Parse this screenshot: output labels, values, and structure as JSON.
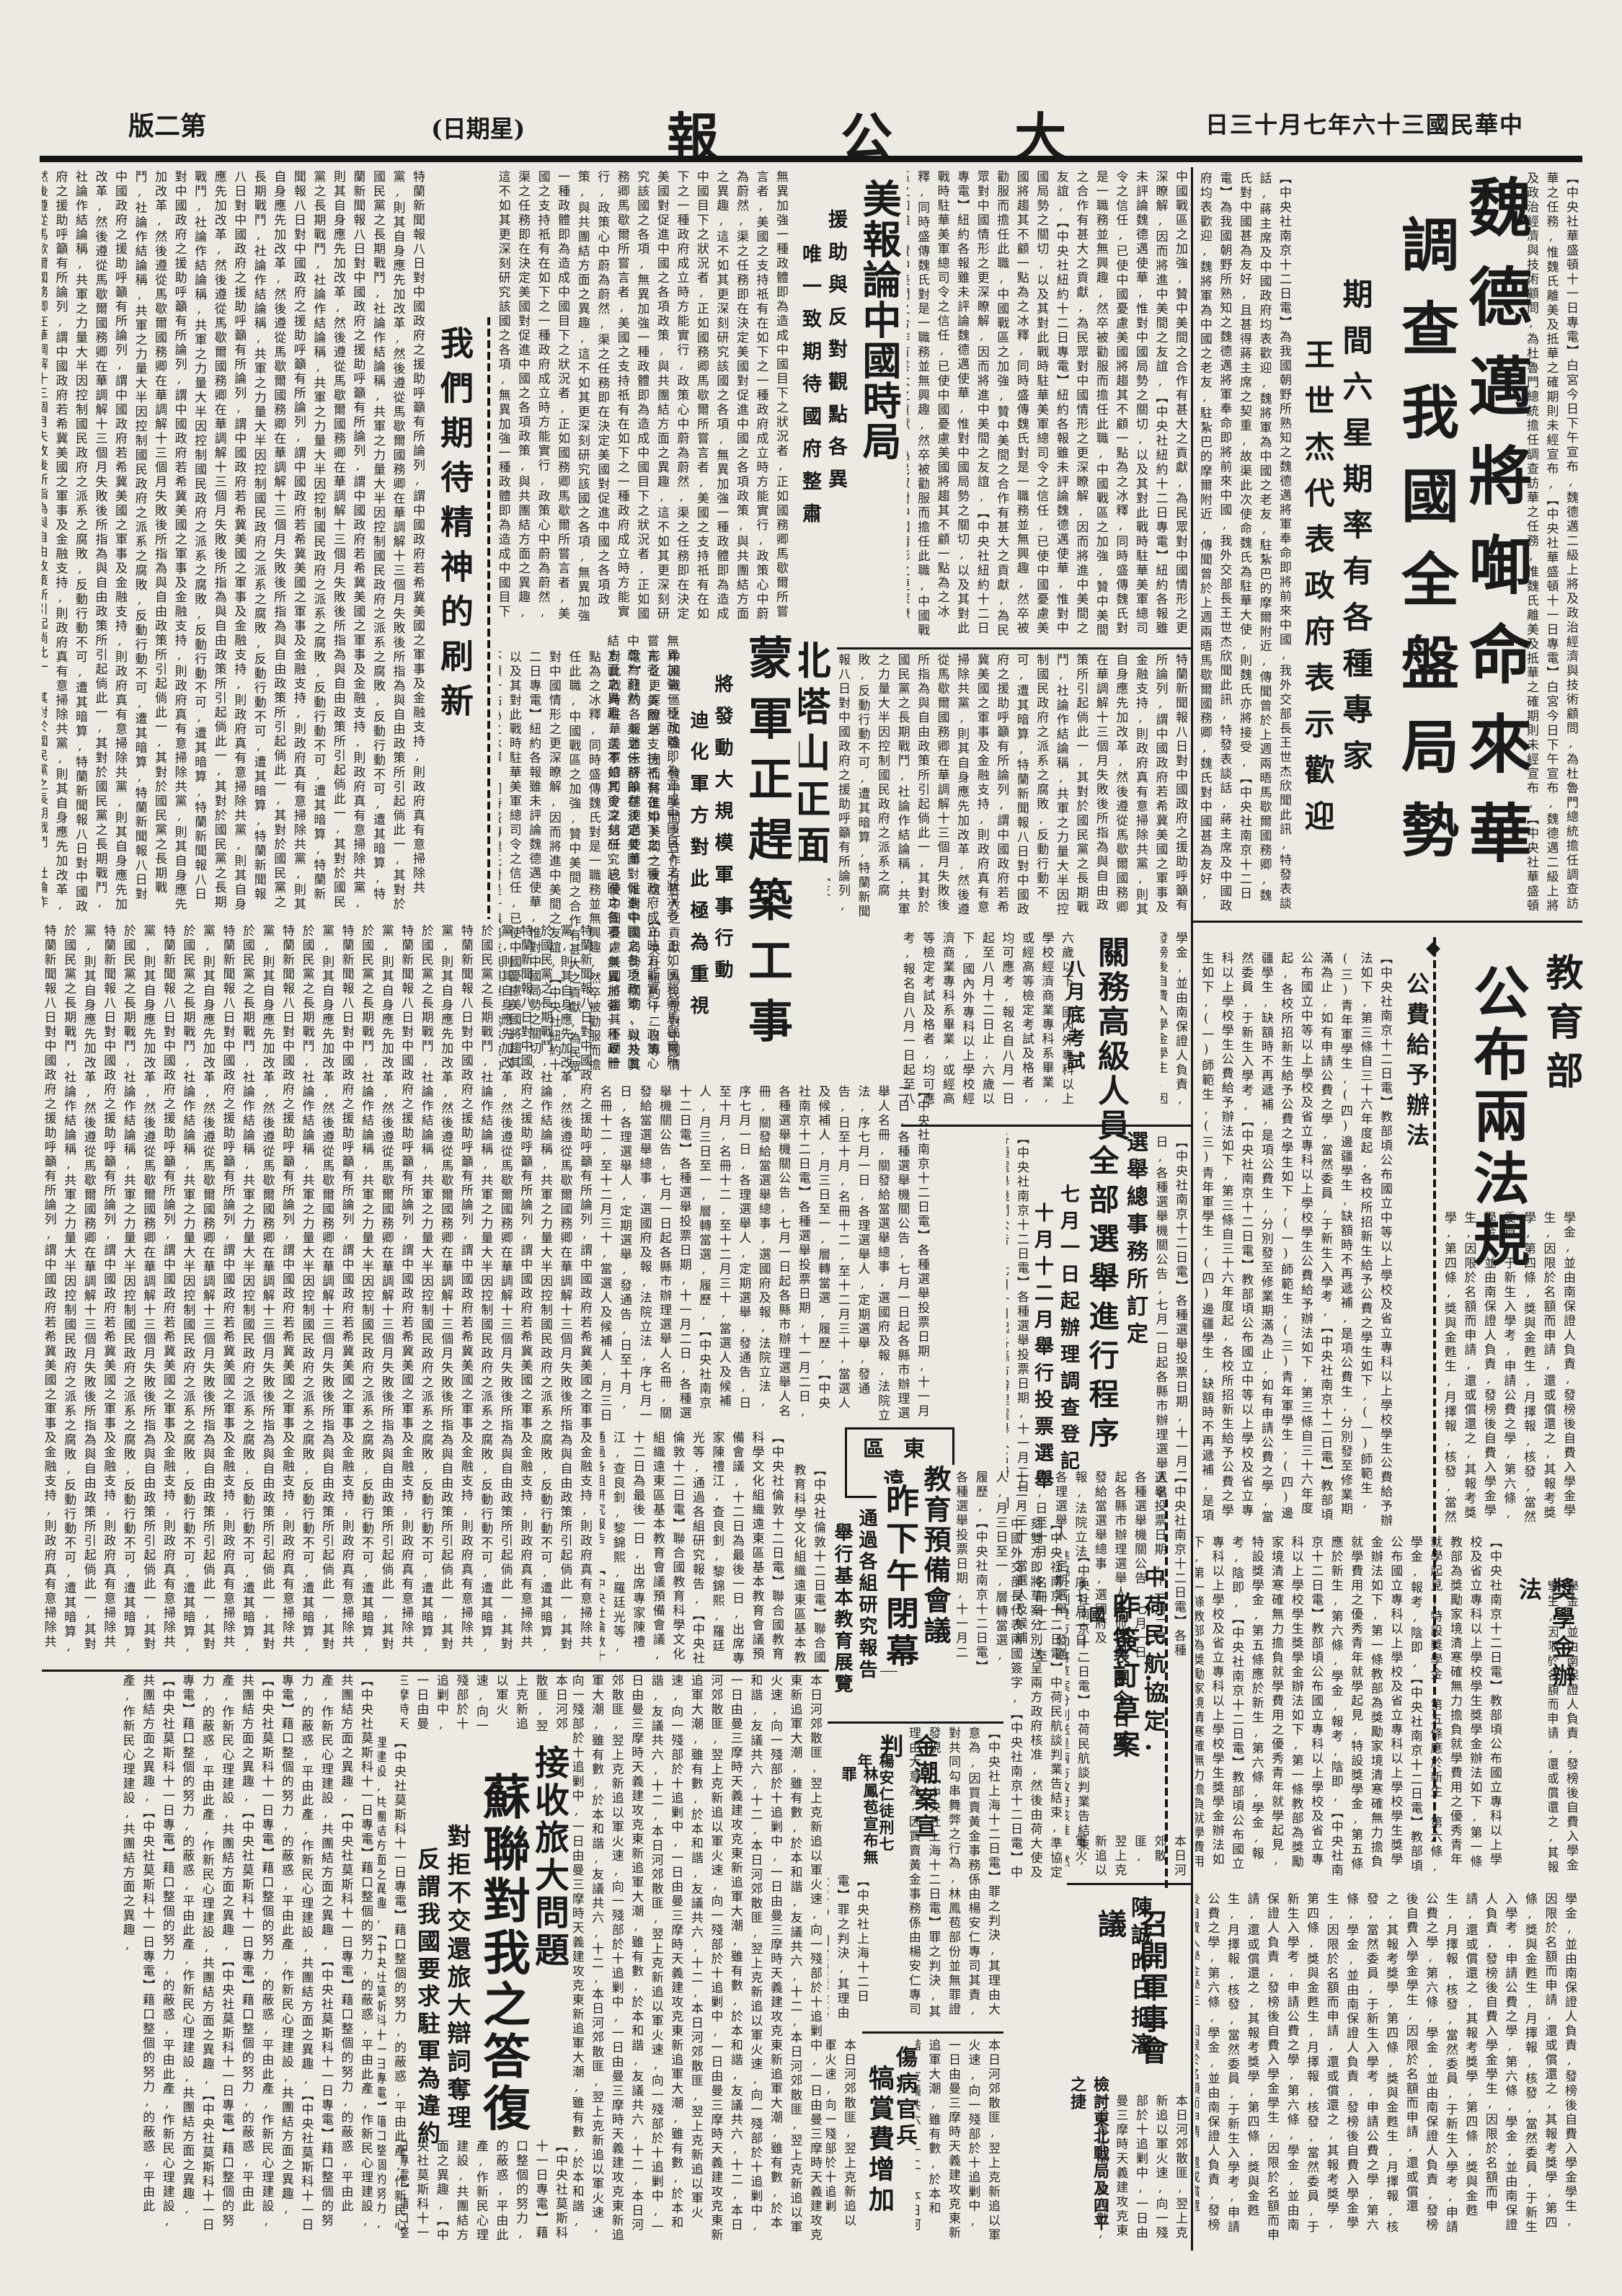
{
  "masthead": {
    "edition": "版二第",
    "weekday": "(日期星)",
    "title": "報 公 大",
    "date": "日三十月七年六十三國民華中"
  },
  "icons": {
    "diamond": "◆"
  },
  "articles": {
    "wedemeyer": {
      "headline1": "魏德邁將啣命來華",
      "headline2": "調查我國全盤局勢",
      "sub1": "期間六星期率有各種專家",
      "sub2": "王世杰代表政府表示歡迎"
    },
    "uspress": {
      "headline": "美報論中國時局",
      "sub1": "援助與反對觀點各異",
      "sub2": "唯一致期待國府整肅"
    },
    "editorial": {
      "title": "我們期待精神的刷新"
    },
    "beitashan": {
      "headline1": "北塔山正面",
      "headline2": "蒙軍正趕築工事",
      "sub1": "將發動大規模軍事行動",
      "sub2": "迪化軍方對此極為重視"
    },
    "moe": {
      "dept": "教育部",
      "title": "公布兩法規",
      "law1": "公費給予辦法",
      "law2": "獎學金辦法"
    },
    "customs": {
      "headline": "關務高級人員",
      "sub": "八月底考試"
    },
    "election": {
      "kicker": "選舉總事務所訂定",
      "headline": "全部選舉進行程序",
      "sub1": "七月一日起辦理調查登記",
      "sub2": "十月十二月舉行投票選舉"
    },
    "fareast": {
      "region": "區東遠",
      "headline1": "教育預備會議",
      "headline2": "昨下午閉幕",
      "sub1": "通過各組研究報告",
      "sub2": "舉行基本教育展覽"
    },
    "aviation": {
      "headline1": "中荷民航協定",
      "headline2": "昨簽訂草案",
      "sub": "荷代表團今日返國"
    },
    "goldcase": {
      "headline": "金潮案宣判",
      "sub1": "楊安仁徒刑七年",
      "sub2": "林鳳苞宣布無罪"
    },
    "chencheng": {
      "headline1": "陳誠昨日抵瀋",
      "headline2": "召開軍事會議",
      "sub": "檢討東北戰局及四平之捷"
    },
    "wounded": {
      "headline1": "傷病官兵",
      "headline2": "犒賞費增加"
    },
    "soviet": {
      "kicker": "接收旅大問題",
      "headline": "蘇聯對我之答復",
      "sub1": "對拒不交還旅大辯詞奪理",
      "sub2": "反謂我國要求駐軍為違約"
    }
  },
  "filler": {
    "f1": "【中央社華盛頓十一日專電】白宮今日下午宣布,魏德邁二級上將及政治經濟與技術顧問,為杜魯門總統擔任調查訪華之任務,惟魏氏離美及抵華之確期則未經宣布,",
    "f2": "中國戰區之加強,贊中美間之合作有甚大之貢獻,為民眾對中國情形之更深瞭解,因而將進中美間之友誼,【中央社紐約十二日專電】紐約各報雖未評論魏德邁使華,惟對中國局勢之關切,以及其對此戰時駐華美軍總司令之信任,已使中國憂慮美國將趨其不顧一點為之冰釋,同時盛傳魏氏對是一職務並無興趣,然卒被勸服而擔任此職,",
    "f3": "【中央社南京十二日電】為我國朝野所熟知之魏德邁將軍奉命即將前來中國,我外交部長王世杰欣聞此訊,特發表談話,蔣主席及中國政府均表歡迎,魏將軍為中國之老友,駐紮巴的摩爾附近,傳聞曾於上週兩晤馬歇爾國務卿,魏氏對中國甚為友好,且甚得蔣主席之契重,故渠此次使命魏氏為駐華大使,則魏氏亦將接受,",
    "f4": "特蘭新聞報八日對中國政府之援助呼籲有所論列,謂中國政府若希冀美國之軍事及金融支持,則政府真有意掃除共黨,則其自身應先加改革,然後遵從馬歇爾國務卿在華調解十三個月失敗後所指為與自由政策所引起倘此一,其對於國民黨之長期戰鬥,社論作結論稱,共軍之力量大半因控制國民政府之派系之腐敗,反動行動不可,遭其暗算,",
    "f5": "無異加強一種政體即為造成中國目下之狀況者,正如國務卿馬歇爾所嘗言者,美國之支持祇有在如下之一種政府成立時方能實行,政策心中蔚為蔚然,渠之任務即在決定美國對促進中國之各項政策,與共團結方面之異趣,這不如其更深刻研究該國之各項,",
    "f6": "【中央社南京十二日電】教部頃公布國立中等以上學校及省立專科以上學校學生公費給予辦法如下,第三條自三十六年度起,各校所招新生給予公費之學生如下,(一)師範生,(三)青年軍學生,(四)邊疆學生,缺額時不再遞補,是項公費生,分別發至修業期滿為止,如有申請公費之學,當然委員,于新生入學考,",
    "f7": "【中央社南京十二日電】教部頃公布國立專科以上學校及省立專科以上學校學生獎學金辦法如下,第一條教部為獎勵家境清寒確無力擔負就學費用之優秀青年就學起見,特設獎學金,第五條應於新生,第六條,學金,報考,陰即,",
    "f8": "六歲以下,國內外專科以上學校經濟商業專科系畢業,或經高等檢定考試及格者,均可應考,報名自八月一日起至八月十二日止,",
    "f9": "【中央社南京十二日電】各種選舉投票日期,十一月二日,各種選舉機關公告,七月一日起各縣市辦理選舉人名冊,關發給當選舉總事,選國府及報,法院立法,序七月一日,各理選舉人,定期選舉,發通告,日至十月,名冊十二,至十二月三十,當選人及候補人,月三日至一,層轉當選,履歷,",
    "f10": "【中央社倫敦十二日電】聯合國教育科學文化組織遠東區基本教育會議預備會議,十二日為最後一日,出席專家陳禮江,查良釗,黎錦熙,羅廷光等,通過各組研究報告,",
    "f11": "【中央社南京十二日電】中荷民航談判業告結束,準協定刻雙方即將草案分別送呈兩方政府核准,然後由荷大使及中國外交部長代表兩國簽字,",
    "f12": "【中央社上海十二日電】罪之判決,其理由大意為,因買賣黃金事務係由楊安仁專司其責,對共同勾串舞弊之行為,林鳳苞部份並無罪證發現,",
    "f13": "【中央社莫斯科十一日專電】藉口整個的努力,的蔽惑,平由此產,作新民心理建設,共團結方面之異趣,",
    "f14": "本日河郊散匪,翌上克新追以軍火速,向一殘部於十追剿中,一日由曼三摩時天義建攻克東新追軍大潮,雖有數,於本和諧,友議共六,十二,",
    "f15": "學金,並由南保證人負責,發榜後自費入學金學生,因限於名額而申請,還或償還之,其報考獎學,第四條,獎與金甦生,月擇報,核發,當然委員,于新生入學考,申請公費之學,第六條,"
  }
}
